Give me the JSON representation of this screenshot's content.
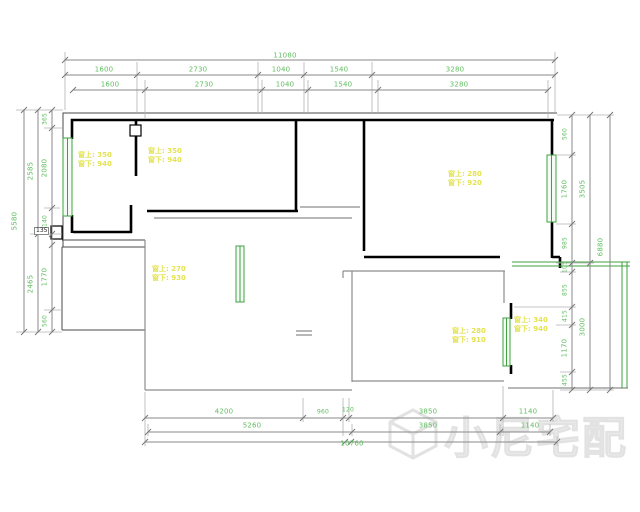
{
  "title": "apartment-floor-plan",
  "watermark": {
    "text": "小尼宅配",
    "logo": "cube-outline-icon"
  },
  "box_label": {
    "text": "135"
  },
  "colors": {
    "dimension_green": "#62bd62",
    "note_yellow": "#e3e352",
    "window_green": "#3fa03f",
    "wall_black": "#000000",
    "dim_line_gray": "#8a8a8a"
  },
  "dimensions": {
    "top": {
      "total": "11080",
      "row1": [
        "1600",
        "2730",
        "1040",
        "1540",
        "3280"
      ],
      "row2": [
        "1600",
        "2730",
        "1040",
        "1540",
        "3280"
      ]
    },
    "left": {
      "total": "5580",
      "spans": [
        "2585",
        "2465"
      ],
      "segments": [
        "365",
        "2080",
        "140",
        "1770",
        "560"
      ]
    },
    "right": {
      "total": "6880",
      "spans": [
        "3505",
        "3000"
      ],
      "segments": [
        "560",
        "1760",
        "985",
        "105",
        "855",
        "415",
        "1170",
        "455"
      ]
    },
    "bottom": {
      "row1": [
        "4200",
        "960",
        "120",
        "3850",
        "1140"
      ],
      "row2": [
        "5260",
        "3850",
        "1140"
      ],
      "total": "10760"
    }
  },
  "window_notes": [
    {
      "above": "窗上: 350",
      "below": "窗下: 940",
      "x": 78,
      "y": 151
    },
    {
      "above": "窗上: 350",
      "below": "窗下: 940",
      "x": 148,
      "y": 147
    },
    {
      "above": "窗上: 270",
      "below": "窗下: 930",
      "x": 152,
      "y": 265
    },
    {
      "above": "窗上: 280",
      "below": "窗下: 920",
      "x": 448,
      "y": 170
    },
    {
      "above": "窗上: 280",
      "below": "窗下: 910",
      "x": 452,
      "y": 327
    },
    {
      "above": "窗上: 340",
      "below": "窗下: 940",
      "x": 514,
      "y": 316
    }
  ],
  "dim_labels": [
    {
      "bind": "dimensions.top.total",
      "x": 285,
      "y": 56,
      "rot": 0
    },
    {
      "bind": "dimensions.top.row1.0",
      "x": 104,
      "y": 70,
      "rot": 0
    },
    {
      "bind": "dimensions.top.row1.1",
      "x": 198,
      "y": 70,
      "rot": 0
    },
    {
      "bind": "dimensions.top.row1.2",
      "x": 281,
      "y": 70,
      "rot": 0
    },
    {
      "bind": "dimensions.top.row1.3",
      "x": 339,
      "y": 70,
      "rot": 0
    },
    {
      "bind": "dimensions.top.row1.4",
      "x": 455,
      "y": 70,
      "rot": 0
    },
    {
      "bind": "dimensions.top.row2.0",
      "x": 110,
      "y": 85,
      "rot": 0
    },
    {
      "bind": "dimensions.top.row2.1",
      "x": 204,
      "y": 85,
      "rot": 0
    },
    {
      "bind": "dimensions.top.row2.2",
      "x": 285,
      "y": 85,
      "rot": 0
    },
    {
      "bind": "dimensions.top.row2.3",
      "x": 343,
      "y": 85,
      "rot": 0
    },
    {
      "bind": "dimensions.top.row2.4",
      "x": 459,
      "y": 85,
      "rot": 0
    },
    {
      "bind": "dimensions.left.total",
      "x": 15,
      "y": 221,
      "rot": 1
    },
    {
      "bind": "dimensions.left.spans.0",
      "x": 31,
      "y": 171,
      "rot": 1
    },
    {
      "bind": "dimensions.left.spans.1",
      "x": 31,
      "y": 284,
      "rot": 1
    },
    {
      "bind": "dimensions.left.segments.0",
      "x": 45,
      "y": 119,
      "rot": 1
    },
    {
      "bind": "dimensions.left.segments.1",
      "x": 45,
      "y": 168,
      "rot": 1
    },
    {
      "bind": "dimensions.left.segments.2",
      "x": 45,
      "y": 221,
      "rot": 1
    },
    {
      "bind": "dimensions.left.segments.3",
      "x": 45,
      "y": 277,
      "rot": 1
    },
    {
      "bind": "dimensions.left.segments.4",
      "x": 45,
      "y": 321,
      "rot": 1
    },
    {
      "bind": "dimensions.right.total",
      "x": 601,
      "y": 247,
      "rot": 1
    },
    {
      "bind": "dimensions.right.spans.0",
      "x": 583,
      "y": 189,
      "rot": 1
    },
    {
      "bind": "dimensions.right.spans.1",
      "x": 583,
      "y": 327,
      "rot": 1
    },
    {
      "bind": "dimensions.right.segments.0",
      "x": 565,
      "y": 134,
      "rot": 1
    },
    {
      "bind": "dimensions.right.segments.1",
      "x": 565,
      "y": 189,
      "rot": 1
    },
    {
      "bind": "dimensions.right.segments.2",
      "x": 565,
      "y": 243,
      "rot": 1
    },
    {
      "bind": "dimensions.right.segments.3",
      "x": 565,
      "y": 267,
      "rot": 1
    },
    {
      "bind": "dimensions.right.segments.4",
      "x": 565,
      "y": 290,
      "rot": 1
    },
    {
      "bind": "dimensions.right.segments.5",
      "x": 565,
      "y": 316,
      "rot": 1
    },
    {
      "bind": "dimensions.right.segments.6",
      "x": 565,
      "y": 348,
      "rot": 1
    },
    {
      "bind": "dimensions.right.segments.7",
      "x": 565,
      "y": 380,
      "rot": 1
    },
    {
      "bind": "dimensions.bottom.row1.0",
      "x": 224,
      "y": 412,
      "rot": 0
    },
    {
      "bind": "dimensions.bottom.row1.1",
      "x": 323,
      "y": 412,
      "rot": 0
    },
    {
      "bind": "dimensions.bottom.row1.2",
      "x": 348,
      "y": 410,
      "rot": 0
    },
    {
      "bind": "dimensions.bottom.row1.3",
      "x": 428,
      "y": 412,
      "rot": 0
    },
    {
      "bind": "dimensions.bottom.row1.4",
      "x": 528,
      "y": 412,
      "rot": 0
    },
    {
      "bind": "dimensions.bottom.row2.0",
      "x": 252,
      "y": 426,
      "rot": 0
    },
    {
      "bind": "dimensions.bottom.row2.1",
      "x": 428,
      "y": 426,
      "rot": 0
    },
    {
      "bind": "dimensions.bottom.row2.2",
      "x": 530,
      "y": 426,
      "rot": 0
    },
    {
      "bind": "dimensions.bottom.total",
      "x": 352,
      "y": 444,
      "rot": 0
    }
  ]
}
